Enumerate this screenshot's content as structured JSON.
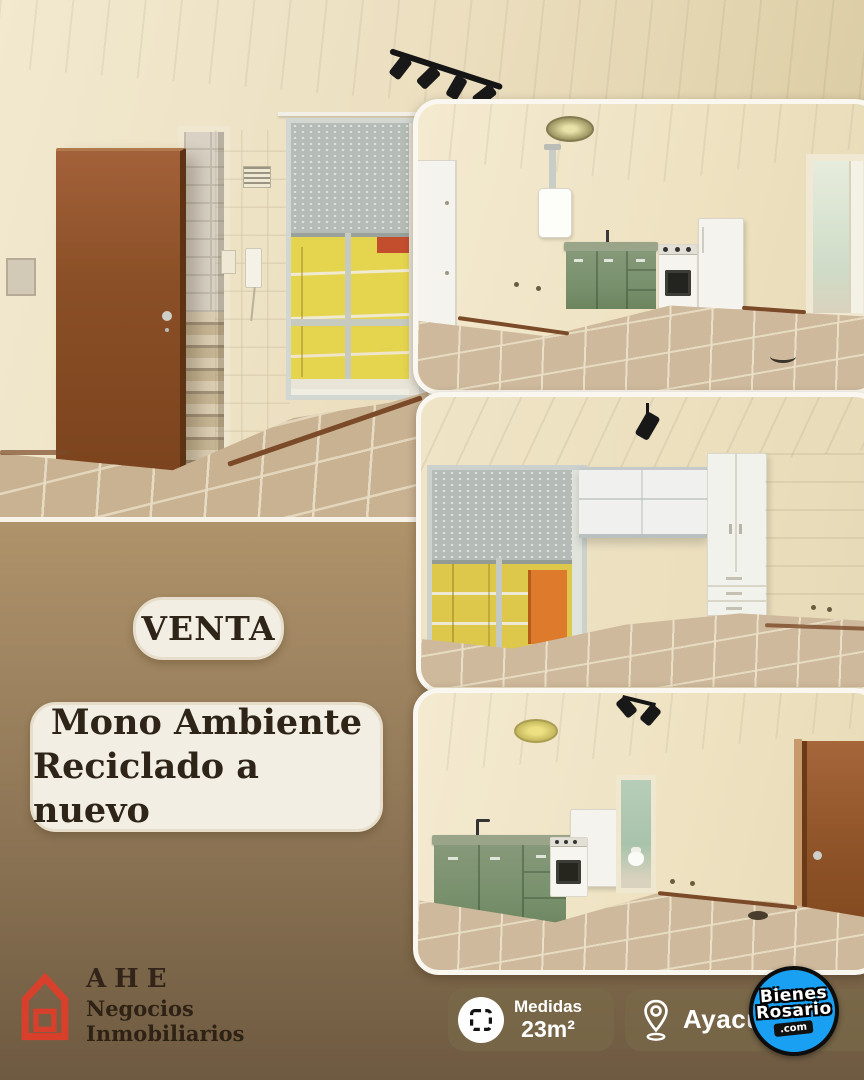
{
  "flyer_type": "real-estate-listing",
  "colors": {
    "background_top": "#c9ad82",
    "background_bottom": "#6b5840",
    "pill_bg": "#f3eee3",
    "text_dark": "#2e2417",
    "badge_bg": "rgba(120,106,72,0.58)",
    "badge_text": "#ffffff",
    "agency_red": "#d8402c",
    "watermark_blue": "#1aa0f2",
    "cabinet_green": "#78906c",
    "door_brown": "#8a4f26"
  },
  "sale_badge": {
    "label": "VENTA"
  },
  "title": {
    "line1": "Mono Ambiente",
    "line2": "Reciclado a nuevo"
  },
  "agency": {
    "name": "AHE",
    "tagline": "Negocios Inmobiliarios",
    "icon": "house-outline-icon"
  },
  "stats": {
    "measures": {
      "icon": "area-dashed-square-icon",
      "label": "Medidas",
      "value": "23m²"
    },
    "location": {
      "icon": "location-pin-icon",
      "value": "Ayacucho"
    }
  },
  "watermark": {
    "icon": "bienes-rosario-circle-logo",
    "line1": "Bienes",
    "line2": "Rosario",
    "line3": ".com"
  },
  "photos": [
    {
      "id": "hero",
      "description": "Empty room with open wooden door to a staircase, window with half-closed roller shutter and tiled floor"
    },
    {
      "id": "kitchen-top",
      "description": "Kitchen with green cabinet and sink, gas stove, fridge, wall water heater and doorway"
    },
    {
      "id": "room-middle",
      "description": "Main room with large window, roller shutter, white overhead cabinets and wardrobe with drawers"
    },
    {
      "id": "kitchen-bottom",
      "description": "Kitchen with green cabinets, stove, fridge, bathroom doorway and wooden entrance door"
    }
  ]
}
